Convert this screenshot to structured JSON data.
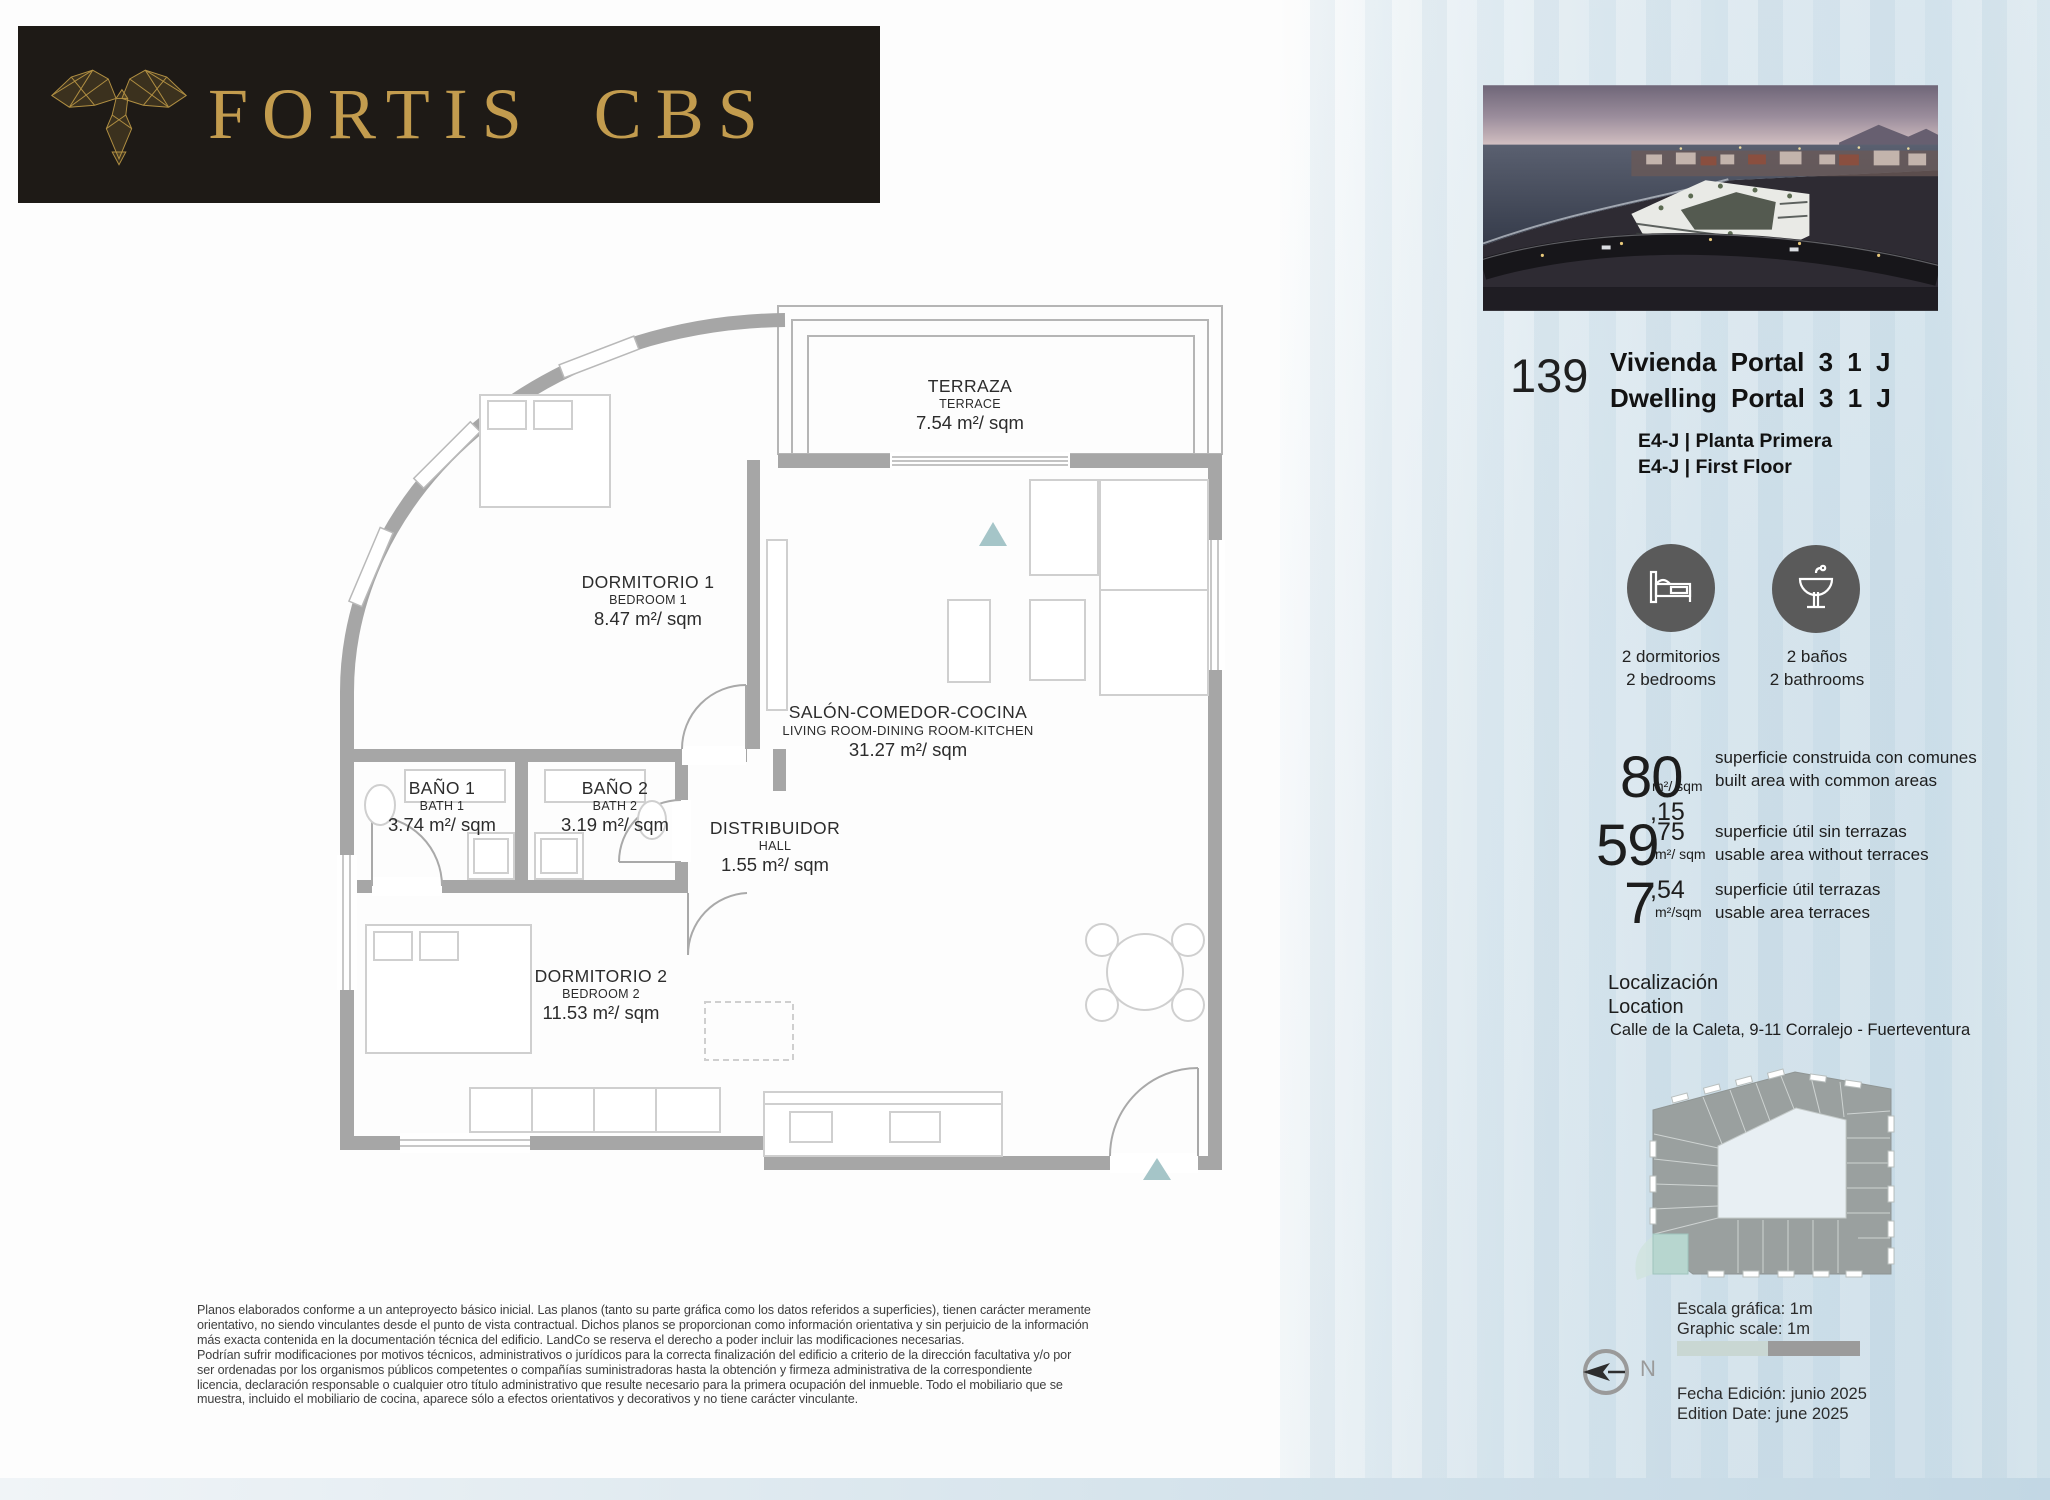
{
  "brand": {
    "name": "FORTIS CBS",
    "logo_icon": "eagle-icon"
  },
  "unit": {
    "number": "139",
    "title_es": "Vivienda Portal 3 1 J",
    "title_en": "Dwelling Portal 3 1 J",
    "floor_es": "E4-J | Planta Primera",
    "floor_en": "E4-J | First Floor"
  },
  "features": [
    {
      "icon": "bed-icon",
      "es": "2 dormitorios",
      "en": "2 bedrooms"
    },
    {
      "icon": "washbasin-icon",
      "es": "2 baños",
      "en": "2 bathrooms"
    }
  ],
  "areas": [
    {
      "int": "80",
      "dec": ",15",
      "unit": "m²/ sqm",
      "es": "superficie construida con comunes",
      "en": "built area with common areas"
    },
    {
      "int": "59",
      "dec": ",75",
      "unit": "m²/ sqm",
      "es": "superficie útil sin terrazas",
      "en": "usable area without terraces"
    },
    {
      "int": "7",
      "dec": ",54",
      "unit": "m²/sqm",
      "es": "superficie útil terrazas",
      "en": "usable area terraces"
    }
  ],
  "location": {
    "label_es": "Localización",
    "label_en": "Location",
    "address": "Calle de la Caleta, 9-11 Corralejo - Fuerteventura"
  },
  "plan": {
    "rooms": [
      {
        "es": "TERRAZA",
        "en": "TERRACE",
        "area": "7.54 m²/ sqm"
      },
      {
        "es": "DORMITORIO 1",
        "en": "BEDROOM 1",
        "area": "8.47 m²/ sqm"
      },
      {
        "es": "SALÓN-COMEDOR-COCINA",
        "en": "LIVING ROOM-DINING ROOM-KITCHEN",
        "area": "31.27 m²/ sqm"
      },
      {
        "es": "BAÑO 1",
        "en": "BATH 1",
        "area": "3.74 m²/ sqm"
      },
      {
        "es": "BAÑO 2",
        "en": "BATH 2",
        "area": "3.19 m²/ sqm"
      },
      {
        "es": "DISTRIBUIDOR",
        "en": "HALL",
        "area": "1.55 m²/ sqm"
      },
      {
        "es": "DORMITORIO 2",
        "en": "BEDROOM 2",
        "area": "11.53 m²/ sqm"
      }
    ]
  },
  "scale": {
    "text": "Escala gráfica: 1m\nGraphic scale: 1m"
  },
  "edition": {
    "text": "Fecha Edición: junio 2025\nEdition Date: june 2025"
  },
  "compass": {
    "label": "N"
  },
  "disclaimer": {
    "text": "Planos elaborados conforme a un anteproyecto básico inicial. Las planos (tanto su parte gráfica como los datos referidos a superficies), tienen carácter meramente\norientativo, no siendo vinculantes desde el punto de vista contractual. Dichos planos se proporcionan como información orientativa y sin perjuicio de la información\nmás exacta contenida en la documentación técnica del edificio. LandCo se reserva el derecho a poder incluir las modificaciones necesarias.\nPodrían sufrir modificaciones por motivos técnicos, administrativos o jurídicos para la correcta finalización del edificio a criterio de la dirección facultativa y/o por\nser ordenadas por los organismos públicos competentes o compañías suministradoras hasta la obtención y firmeza administrativa de la correspondiente\nlicencia, declaración responsable o cualquier otro título administrativo que resulte necesario para la primera ocupación del inmueble. Todo el mobiliario que se\nmuestra, incluido el mobiliario de cocina, aparece sólo a efectos orientativos y decorativos y no tiene carácter vinculante."
  },
  "colors": {
    "brand_gold": "#c39c4e",
    "logo_background": "#1e1a16",
    "wall_gray": "#a6a6a6",
    "accent_teal": "#a5c5c8",
    "watercolor_blue": "#cfe0ea",
    "icon_circle_gray": "#5a5a5a"
  }
}
